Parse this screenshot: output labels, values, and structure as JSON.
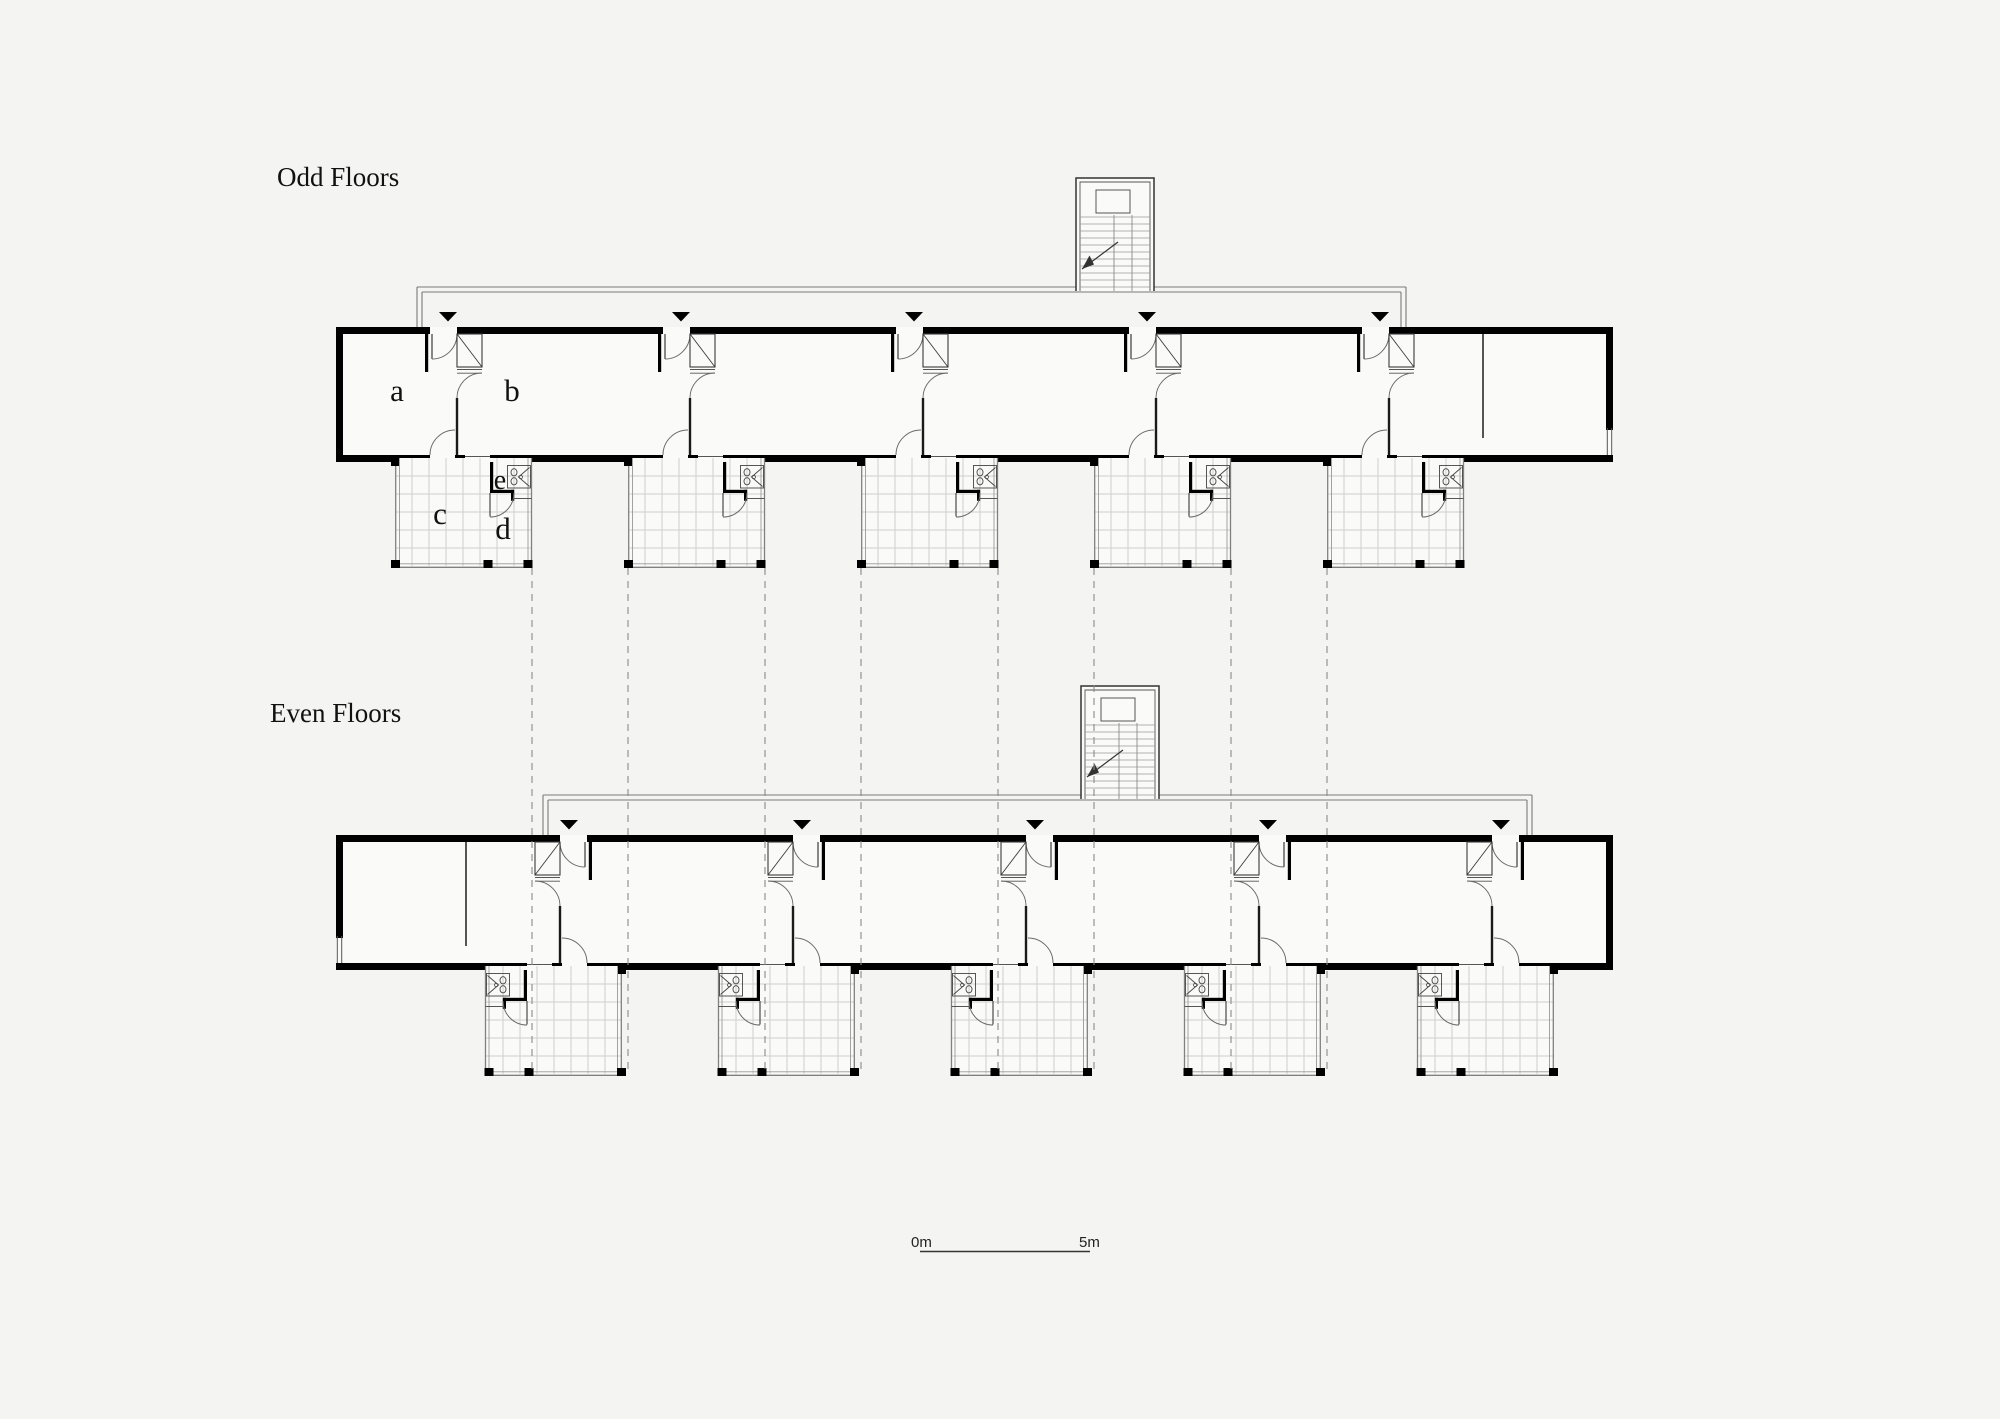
{
  "colors": {
    "background": "#f4f4f2",
    "ink": "#000000",
    "room_fill": "#fafaf9",
    "tile_grid": "#cfcfcb",
    "thin_line": "#777777"
  },
  "plans": [
    {
      "title": "Odd Floors",
      "room_labels": {
        "a": "a",
        "b": "b",
        "c": "c",
        "d": "d",
        "e": "e"
      }
    },
    {
      "title": "Even Floors"
    }
  ],
  "scale_bar": {
    "start_label": "0m",
    "end_label": "5m"
  }
}
